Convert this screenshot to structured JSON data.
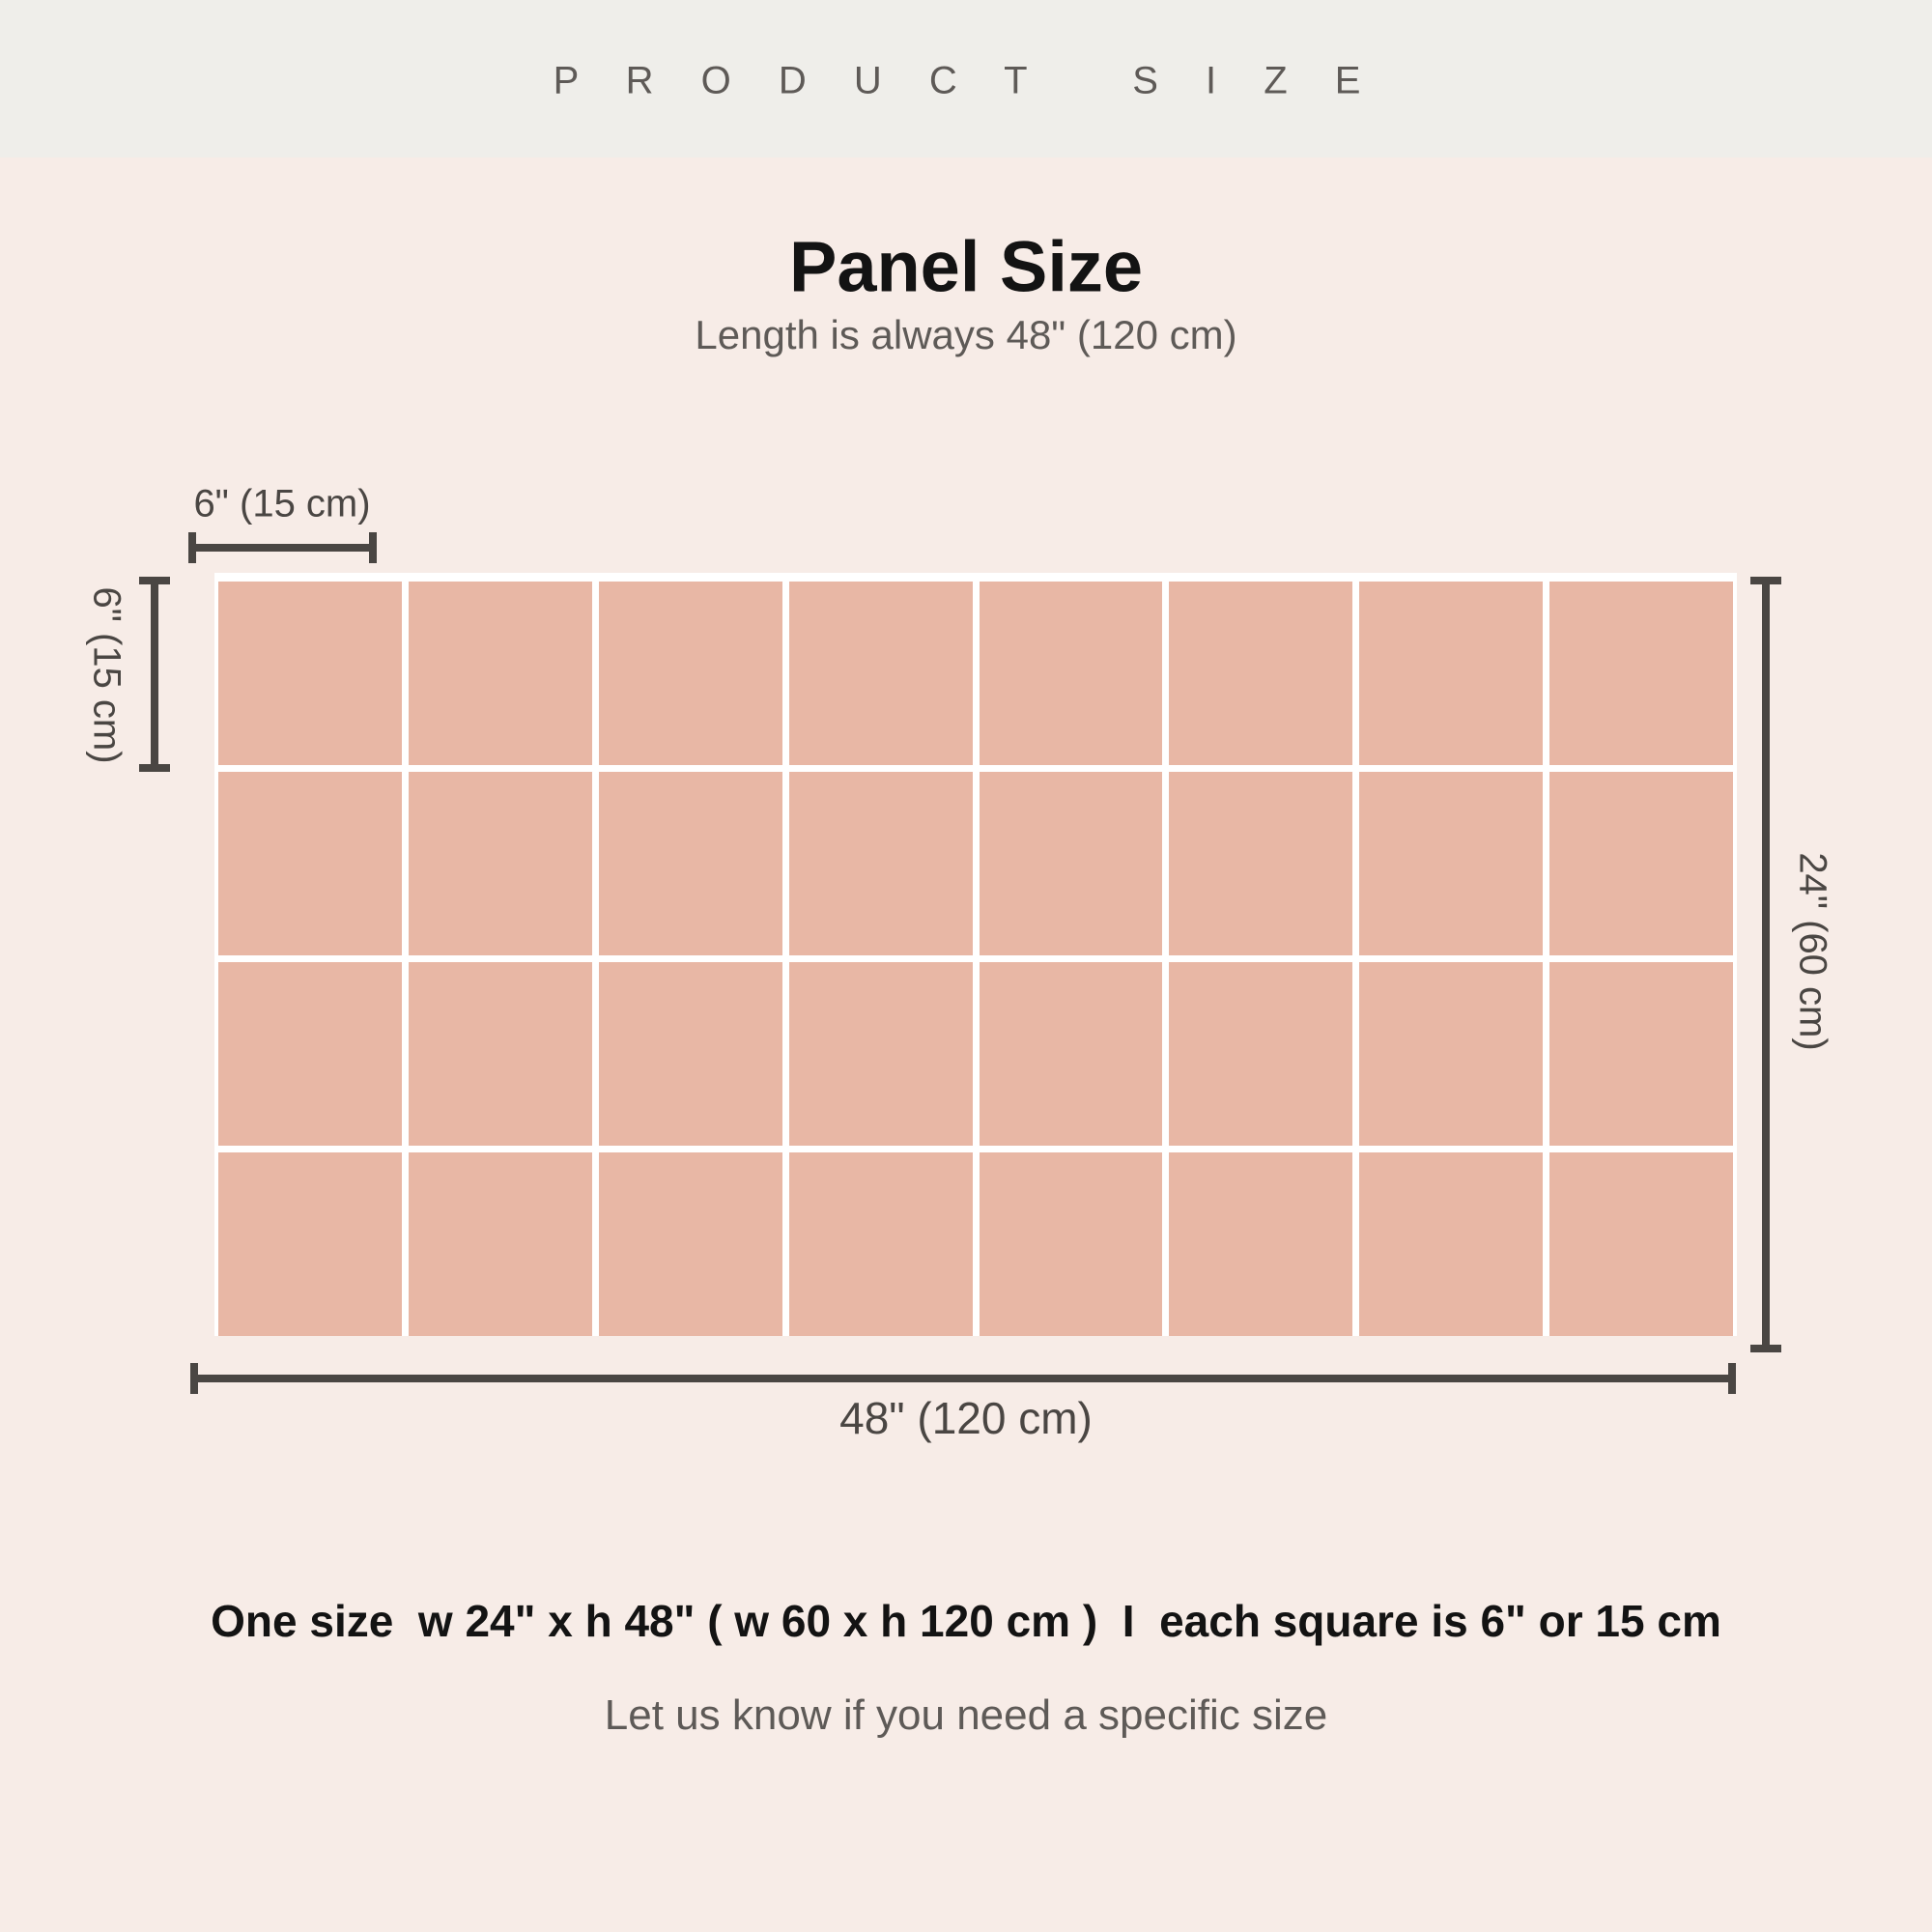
{
  "header": {
    "title": "P R O D U C T   S I Z E"
  },
  "panel": {
    "title": "Panel Size",
    "subtitle": "Length is always 48\" (120 cm)"
  },
  "diagram": {
    "grid": {
      "columns": 8,
      "rows": 4,
      "square_color": "#e8b7a5",
      "gap_color": "#ffffff"
    },
    "dimensions": {
      "square_width": "6\" (15 cm)",
      "square_height": "6\" (15 cm)",
      "panel_height": "24\" (60 cm)",
      "panel_width": "48\" (120 cm)"
    }
  },
  "footer": {
    "size_summary": "One size  w 24\" x h 48\" ( w 60 x h 120 cm )  I  each square is 6\" or 15 cm",
    "note": "Let us know if you need a specific size"
  },
  "colors": {
    "header_background": "#efeeea",
    "page_background": "#f7ece7",
    "square": "#e8b7a5",
    "gap": "#ffffff",
    "dimension": "#4a4643",
    "text_dark": "#131313",
    "text_gray": "#5e5a57"
  }
}
